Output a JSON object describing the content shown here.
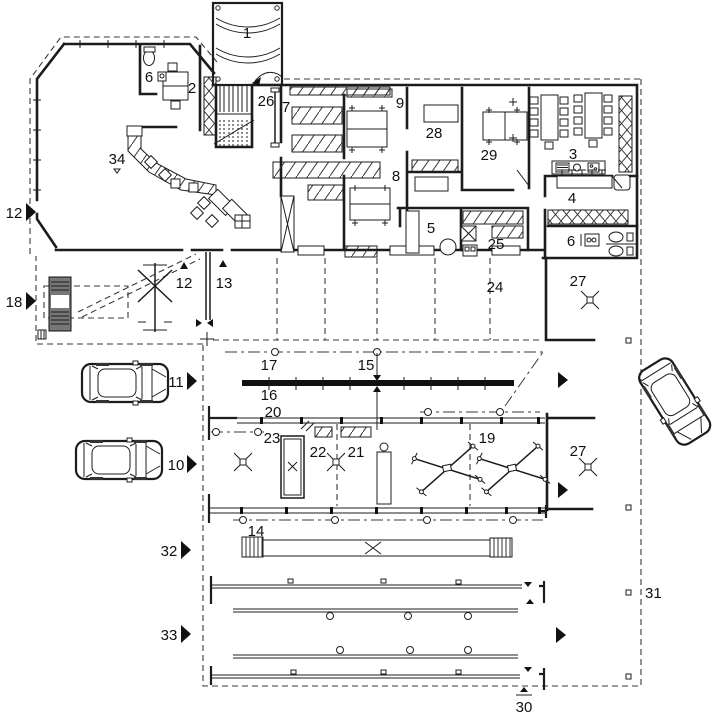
{
  "figure": {
    "type": "architectural floor plan",
    "title": "Ground floor plan — car dealership showroom with service workshop and yard",
    "background_color": "#ffffff",
    "line_color": "#1c1c1c"
  },
  "labels": [
    {
      "id": "canopy",
      "text": "1"
    },
    {
      "id": "office",
      "text": "2"
    },
    {
      "id": "meeting-room",
      "text": "3"
    },
    {
      "id": "counter-bar",
      "text": "4"
    },
    {
      "id": "staff-room",
      "text": "5"
    },
    {
      "id": "wc-showroom",
      "text": "6"
    },
    {
      "id": "wc-workshop",
      "text": "6"
    },
    {
      "id": "corridor",
      "text": "7"
    },
    {
      "id": "workshop-room-8",
      "text": "8"
    },
    {
      "id": "workshop-hall-9",
      "text": "9"
    },
    {
      "id": "car-10",
      "text": "10"
    },
    {
      "id": "car-11",
      "text": "11"
    },
    {
      "id": "entrance-12-margin",
      "text": "12"
    },
    {
      "id": "door-12",
      "text": "12"
    },
    {
      "id": "door-13",
      "text": "13"
    },
    {
      "id": "ramp-14",
      "text": "14"
    },
    {
      "id": "gate-15",
      "text": "15"
    },
    {
      "id": "barrier-16",
      "text": "16"
    },
    {
      "id": "line-17",
      "text": "17"
    },
    {
      "id": "yard-18",
      "text": "18"
    },
    {
      "id": "lift-bay-19",
      "text": "19"
    },
    {
      "id": "wall-20",
      "text": "20"
    },
    {
      "id": "marker-21",
      "text": "21"
    },
    {
      "id": "pit-22",
      "text": "22"
    },
    {
      "id": "line-23",
      "text": "23"
    },
    {
      "id": "bay-24",
      "text": "24"
    },
    {
      "id": "room-25",
      "text": "25"
    },
    {
      "id": "stairs-26",
      "text": "26"
    },
    {
      "id": "washbay-27-upper",
      "text": "27"
    },
    {
      "id": "washbay-27-lower",
      "text": "27"
    },
    {
      "id": "room-28",
      "text": "28"
    },
    {
      "id": "room-29",
      "text": "29"
    },
    {
      "id": "boundary-30",
      "text": "30"
    },
    {
      "id": "boundary-31",
      "text": "31"
    },
    {
      "id": "racks-32",
      "text": "32"
    },
    {
      "id": "racks-33",
      "text": "33"
    },
    {
      "id": "reception-34",
      "text": "34"
    }
  ],
  "icons": {
    "label_arrow": "right-pointing triangle flag",
    "direction_arrow": "solid right-pointing triangle",
    "door_arrow": "small solid triangle",
    "floor_marker": "x-cross with square centre",
    "car_top_view": "car outline seen from above",
    "scissor_lift": "crossed-beam vehicle lift",
    "hatched_bench": "workbench with diagonal hatching",
    "locker_strip": "cross-hatched locker row"
  }
}
